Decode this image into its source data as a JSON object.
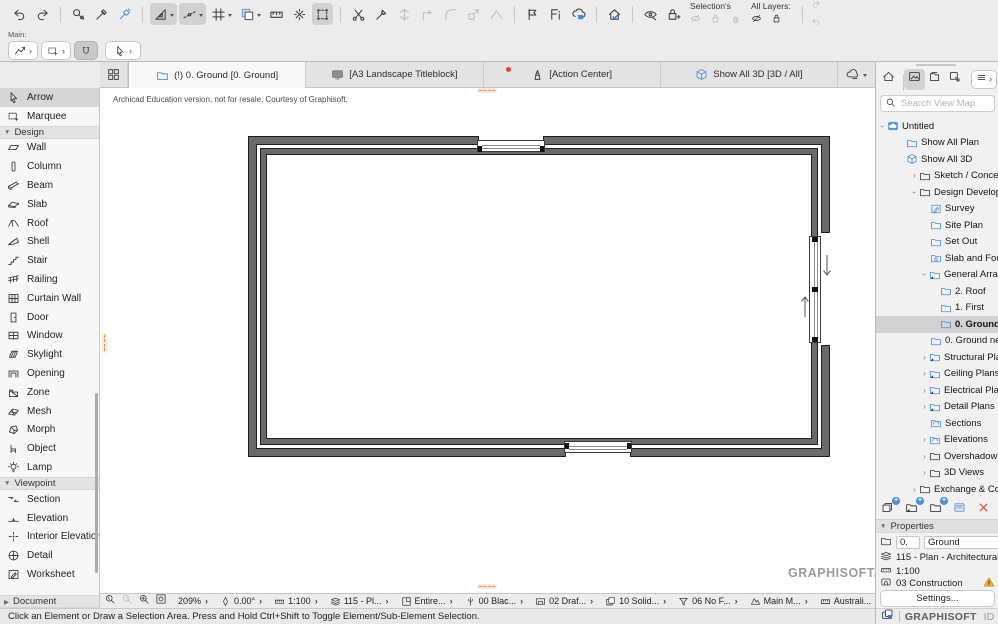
{
  "toolbar_top": {
    "items": [
      {
        "t": "i",
        "n": "undo",
        "g": "undo"
      },
      {
        "t": "i",
        "n": "redo",
        "g": "redo"
      },
      {
        "t": "s"
      },
      {
        "t": "i",
        "n": "pick-parameters",
        "g": "picker"
      },
      {
        "t": "i",
        "n": "pickup-parameters",
        "g": "eyedropper"
      },
      {
        "t": "i",
        "n": "inject-parameters",
        "g": "syringe",
        "blue": 1
      },
      {
        "t": "s"
      },
      {
        "t": "i",
        "n": "snap-tools",
        "g": "setsquare",
        "on": 1,
        "dd": 1
      },
      {
        "t": "i",
        "n": "guide-lines",
        "g": "guides",
        "on": 1,
        "dd": 1
      },
      {
        "t": "i",
        "n": "grid-snap",
        "g": "grid",
        "dd": 1
      },
      {
        "t": "i",
        "n": "trace-reference",
        "g": "trace",
        "dd": 1
      },
      {
        "t": "i",
        "n": "dimension",
        "g": "dim"
      },
      {
        "t": "i",
        "n": "explode",
        "g": "explode"
      },
      {
        "t": "i",
        "n": "edit-plane",
        "g": "editplane",
        "on": 1
      },
      {
        "t": "s"
      },
      {
        "t": "i",
        "n": "trim",
        "g": "scissors"
      },
      {
        "t": "i",
        "n": "adjust",
        "g": "adjust"
      },
      {
        "t": "i",
        "n": "split",
        "g": "split",
        "dis": 1
      },
      {
        "t": "i",
        "n": "intersect",
        "g": "corner",
        "dis": 1
      },
      {
        "t": "i",
        "n": "fillet",
        "g": "fillet",
        "dis": 1
      },
      {
        "t": "i",
        "n": "resize",
        "g": "stretch",
        "dis": 1
      },
      {
        "t": "i",
        "n": "multiply",
        "g": "roofline",
        "dis": 1
      },
      {
        "t": "s"
      },
      {
        "t": "i",
        "n": "markup-flag",
        "g": "flag"
      },
      {
        "t": "i",
        "n": "favorites",
        "g": "favorites"
      },
      {
        "t": "i",
        "n": "cloud-save",
        "g": "cloudsave"
      },
      {
        "t": "s"
      },
      {
        "t": "i",
        "n": "check-model",
        "g": "housecheck"
      },
      {
        "t": "s"
      },
      {
        "t": "i",
        "n": "show-hide-elements",
        "g": "eyearrow"
      },
      {
        "t": "i",
        "n": "lock-elements",
        "g": "lockadd"
      },
      {
        "t": "g",
        "name": "selections-group",
        "label": "Selection's",
        "icons": [
          {
            "n": "selection-hide",
            "g": "eyeslash",
            "dis": 1
          },
          {
            "n": "selection-lock",
            "g": "lock",
            "dis": 1
          },
          {
            "n": "selection-grab",
            "g": "hand",
            "dis": 1
          }
        ]
      },
      {
        "t": "g",
        "name": "all-layers-group",
        "label": "All Layers:",
        "icons": [
          {
            "n": "all-layers-hide",
            "g": "eyeslash"
          },
          {
            "n": "all-layers-lock",
            "g": "lock"
          }
        ]
      },
      {
        "t": "s"
      },
      {
        "t": "st",
        "icons": [
          {
            "n": "redo-alt",
            "g": "redo",
            "dis": 1
          },
          {
            "n": "undo-alt",
            "g": "undo",
            "dis": 1
          }
        ]
      }
    ]
  },
  "toolbar_second": {
    "main_label": "Main:",
    "buttons": [
      {
        "n": "layout-tool",
        "g": "polyarrow",
        "dd": 1
      },
      {
        "n": "marquee-tool",
        "g": "marquee2",
        "dd": 1
      },
      {
        "n": "magnet-snap",
        "g": "magnet",
        "on": 1
      },
      {
        "n": "arrow-tool",
        "g": "arrowcur",
        "dd": 1,
        "wide": 1
      }
    ]
  },
  "tabbar": {
    "tabs": [
      {
        "label": "(!) 0. Ground [0. Ground]",
        "icon": "folderblue",
        "icon_cls": "blue s13",
        "active": true
      },
      {
        "label": "[A3  Landscape Titleblock]",
        "icon": "monitor",
        "icon_cls": "s13"
      },
      {
        "label": "[Action Center]",
        "icon": "lighthouse",
        "icon_cls": "s13",
        "badge": true
      },
      {
        "label": "Show All 3D [3D / All]",
        "icon": "box3d",
        "icon_cls": "blue s13"
      }
    ]
  },
  "education_notice": "Archicad Education version, not for resale. Courtesy of Graphisoft.",
  "toolbox": {
    "rows": [
      {
        "t": "item",
        "label": "Arrow",
        "icon": "arrowcur",
        "selected": true
      },
      {
        "t": "item",
        "label": "Marquee",
        "icon": "marquee2"
      },
      {
        "t": "head",
        "label": "Design",
        "exp": "v"
      },
      {
        "t": "item",
        "label": "Wall",
        "icon": "wall"
      },
      {
        "t": "item",
        "label": "Column",
        "icon": "column"
      },
      {
        "t": "item",
        "label": "Beam",
        "icon": "beam"
      },
      {
        "t": "item",
        "label": "Slab",
        "icon": "slab"
      },
      {
        "t": "item",
        "label": "Roof",
        "icon": "roof"
      },
      {
        "t": "item",
        "label": "Shell",
        "icon": "shell"
      },
      {
        "t": "item",
        "label": "Stair",
        "icon": "stair"
      },
      {
        "t": "item",
        "label": "Railing",
        "icon": "railing"
      },
      {
        "t": "item",
        "label": "Curtain Wall",
        "icon": "curtain"
      },
      {
        "t": "item",
        "label": "Door",
        "icon": "door"
      },
      {
        "t": "item",
        "label": "Window",
        "icon": "window"
      },
      {
        "t": "item",
        "label": "Skylight",
        "icon": "skylight"
      },
      {
        "t": "item",
        "label": "Opening",
        "icon": "opening"
      },
      {
        "t": "item",
        "label": "Zone",
        "icon": "zone"
      },
      {
        "t": "item",
        "label": "Mesh",
        "icon": "mesh"
      },
      {
        "t": "item",
        "label": "Morph",
        "icon": "morph"
      },
      {
        "t": "item",
        "label": "Object",
        "icon": "objectc"
      },
      {
        "t": "item",
        "label": "Lamp",
        "icon": "lamp"
      },
      {
        "t": "head",
        "label": "Viewpoint",
        "exp": "v"
      },
      {
        "t": "item",
        "label": "Section",
        "icon": "sectiont"
      },
      {
        "t": "item",
        "label": "Elevation",
        "icon": "elevationt"
      },
      {
        "t": "item",
        "label": "Interior Elevation",
        "icon": "intelev"
      },
      {
        "t": "item",
        "label": "Detail",
        "icon": "detailt"
      },
      {
        "t": "item",
        "label": "Worksheet",
        "icon": "worksheett"
      }
    ],
    "document_header": {
      "label": "Document",
      "exp": ">"
    }
  },
  "view_map": {
    "search_placeholder": "Search View Map",
    "tree": [
      {
        "label": "Untitled",
        "indent": 2,
        "exp": "v",
        "icon": "cloudtree"
      },
      {
        "label": "Show All Plan",
        "indent": 30,
        "icon": "folderblue",
        "cls": "blue"
      },
      {
        "label": "Show All 3D",
        "indent": 30,
        "icon": "box3d",
        "cls": "blue"
      },
      {
        "label": "Sketch / Concept",
        "indent": 34,
        "exp": ">",
        "icon": "foldergray"
      },
      {
        "label": "Design Development",
        "indent": 34,
        "exp": "v",
        "icon": "foldergray"
      },
      {
        "label": "Survey",
        "indent": 54,
        "icon": "sheetpencil",
        "cls": "blue"
      },
      {
        "label": "Site Plan",
        "indent": 54,
        "icon": "folderblue",
        "cls": "blue"
      },
      {
        "label": "Set Out",
        "indent": 54,
        "icon": "folderblue",
        "cls": "blue"
      },
      {
        "label": "Slab and Foundation",
        "indent": 54,
        "icon": "foldercam",
        "cls": "blue"
      },
      {
        "label": "General Arrangement",
        "indent": 44,
        "exp": "v",
        "icon": "folderclone",
        "cls": "blue"
      },
      {
        "label": "2. Roof",
        "indent": 64,
        "icon": "folderblue",
        "cls": "blue"
      },
      {
        "label": "1. First",
        "indent": 64,
        "icon": "folderblue",
        "cls": "blue"
      },
      {
        "label": "0. Ground",
        "indent": 64,
        "icon": "folderblue",
        "cls": "blue",
        "selected": true
      },
      {
        "label": "0. Ground new",
        "indent": 54,
        "icon": "folderblue",
        "cls": "blue"
      },
      {
        "label": "Structural Plans",
        "indent": 44,
        "exp": ">",
        "icon": "folderclone",
        "cls": "blue"
      },
      {
        "label": "Ceiling Plans",
        "indent": 44,
        "exp": ">",
        "icon": "folderclone",
        "cls": "blue"
      },
      {
        "label": "Electrical Plans",
        "indent": 44,
        "exp": ">",
        "icon": "folderclone",
        "cls": "blue"
      },
      {
        "label": "Detail Plans (create d",
        "indent": 44,
        "exp": ">",
        "icon": "folderclone",
        "cls": "blue"
      },
      {
        "label": "Sections",
        "indent": 54,
        "icon": "folderarc",
        "cls": "blue"
      },
      {
        "label": "Elevations",
        "indent": 44,
        "exp": ">",
        "icon": "folderarc",
        "cls": "blue"
      },
      {
        "label": "Overshadowing Plans",
        "indent": 44,
        "exp": ">",
        "icon": "foldergray"
      },
      {
        "label": "3D Views",
        "indent": 44,
        "exp": ">",
        "icon": "foldergray"
      },
      {
        "label": "Exchange & Coordinatio",
        "indent": 34,
        "exp": ">",
        "icon": "foldergray"
      }
    ],
    "actions": [
      {
        "n": "new-viewpoint",
        "g": "viewclone",
        "plus": true
      },
      {
        "n": "new-clone-folder",
        "g": "folderclone2",
        "plus": true
      },
      {
        "n": "new-folder",
        "g": "folderplain",
        "plus": true
      },
      {
        "n": "view-settings",
        "g": "dialogic"
      },
      {
        "n": "delete-view",
        "g": "deletex"
      }
    ]
  },
  "properties": {
    "header": "Properties",
    "id_value": "0.",
    "name_value": "Ground",
    "layer": "115 - Plan - Architectural",
    "scale": "1:100",
    "penset": "03 Construction",
    "settings_label": "Settings..."
  },
  "footer": {
    "brand_bold": "GRAPHISOFT",
    "brand_light": "ID"
  },
  "canvas": {
    "watermark": "GRAPHISOFT."
  },
  "quick_options": {
    "zoom_tools": [
      {
        "n": "zoom-back",
        "g": "zoomback"
      },
      {
        "n": "zoom-forward",
        "g": "zoomfwd",
        "dis": 1
      },
      {
        "n": "zoom-increase",
        "g": "zoomin"
      },
      {
        "n": "fit-in-window",
        "g": "zoomfit"
      }
    ],
    "options": [
      {
        "n": "zoom-level",
        "label": "209%"
      },
      {
        "n": "orientation",
        "g": "orient",
        "label": "0.00°"
      },
      {
        "n": "scale",
        "g": "scaleic",
        "label": "1:100"
      },
      {
        "n": "layer-combination",
        "g": "layersic",
        "label": "115 - Pl..."
      },
      {
        "n": "structure-display",
        "g": "floorplanic",
        "label": "Entire..."
      },
      {
        "n": "pen-set",
        "g": "penu",
        "label": "00 Blac..."
      },
      {
        "n": "model-view-options",
        "g": "displayic",
        "label": "02 Draf..."
      },
      {
        "n": "renovation-filter",
        "g": "renoic",
        "label": "10 Solid..."
      },
      {
        "n": "graphic-override",
        "g": "filteric",
        "label": "06 No F..."
      },
      {
        "n": "partial-structure",
        "g": "modelic",
        "label": "Main M..."
      },
      {
        "n": "working-units",
        "g": "unitsic",
        "label": "Australi..."
      }
    ]
  },
  "status_message": "Click an Element or Draw a Selection Area. Press and Hold Ctrl+Shift to Toggle Element/Sub-Element Selection."
}
